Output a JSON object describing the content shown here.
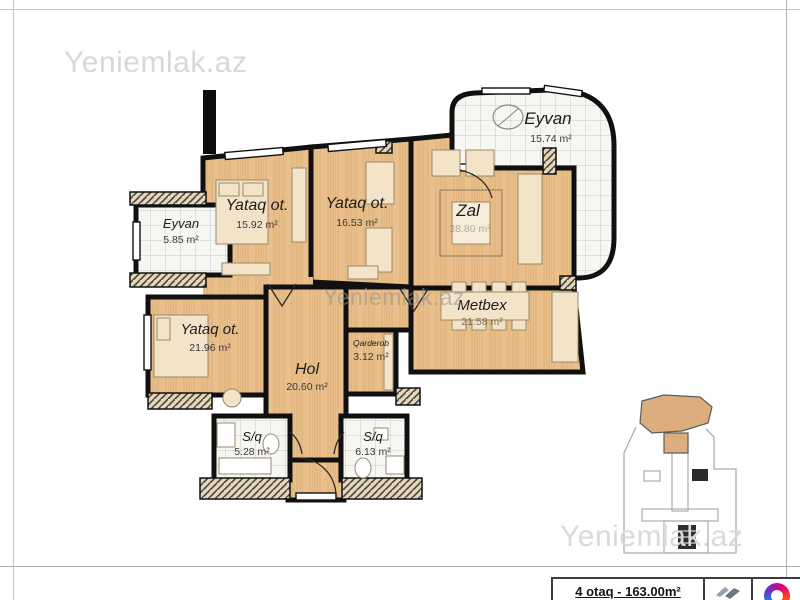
{
  "page": {
    "watermarks": {
      "top_left": "Yeniemlak.az",
      "center": "Yeniemlak.az",
      "bottom_right": "Yeniemlak.az"
    }
  },
  "plan": {
    "rooms": [
      {
        "id": "eyvan-top",
        "name": "Eyvan",
        "area": "15.74 m²"
      },
      {
        "id": "eyvan-left",
        "name": "Eyvan",
        "area": "5.85 m²"
      },
      {
        "id": "yataq-1",
        "name": "Yataq ot.",
        "area": "15.92 m²"
      },
      {
        "id": "yataq-2",
        "name": "Yataq ot.",
        "area": "16.53 m²"
      },
      {
        "id": "zal",
        "name": "Zal",
        "area": "38.80 m²"
      },
      {
        "id": "metbex",
        "name": "Metbex",
        "area": "21.58 m²"
      },
      {
        "id": "yataq-3",
        "name": "Yataq ot.",
        "area": "21.96 m²"
      },
      {
        "id": "hol",
        "name": "Hol",
        "area": "20.60 m²"
      },
      {
        "id": "qarderob",
        "name": "Qarderob",
        "area": "3.12 m²"
      },
      {
        "id": "sq-left",
        "name": "S/q",
        "area": "5.28 m²"
      },
      {
        "id": "sq-right",
        "name": "S/q",
        "area": "6.13 m²"
      }
    ]
  },
  "info_box": {
    "summary": "4 otaq - 163.00m²"
  },
  "icons": {
    "developer_logo": "wing-mark",
    "agency_logo": "q-ring-mark"
  },
  "colors": {
    "wood": "#e9bf8b",
    "tile": "#f6f6f3",
    "wall": "#101010",
    "hatch_bg": "#e7d6b5",
    "watermark": "#d8d8d8",
    "frame": "#c4c4cb"
  }
}
